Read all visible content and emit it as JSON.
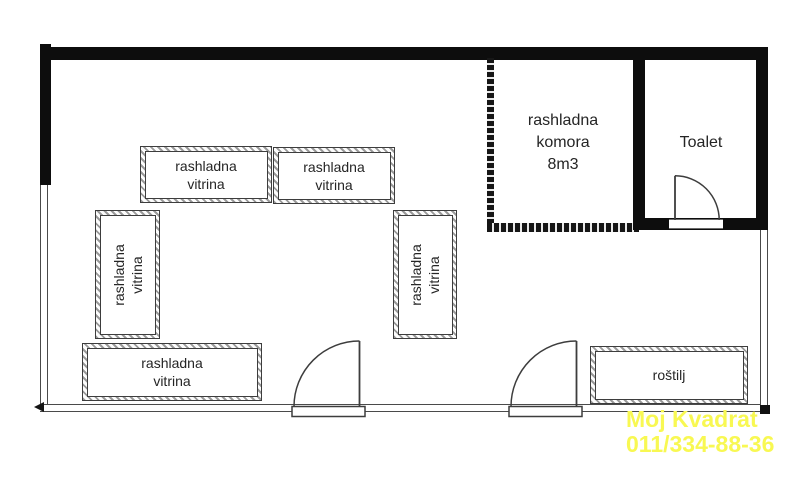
{
  "furniture": [
    {
      "id": "vitrina-top-left",
      "line1": "rashladna",
      "line2": "vitrina"
    },
    {
      "id": "vitrina-top-right",
      "line1": "rashladna",
      "line2": "vitrina"
    },
    {
      "id": "vitrina-left-vertical",
      "line1": "rashladna",
      "line2": "vitrina"
    },
    {
      "id": "vitrina-middle-vertical",
      "line1": "rashladna",
      "line2": "vitrina"
    },
    {
      "id": "vitrina-bottom-left",
      "line1": "rashladna",
      "line2": "vitrina"
    },
    {
      "id": "rostilj",
      "line1": "roštilj"
    }
  ],
  "rooms": {
    "komora": {
      "line1": "rashladna",
      "line2": "komora",
      "line3": "8m3"
    },
    "toalet": {
      "label": "Toalet"
    }
  },
  "watermark": {
    "line1": "Moj Kvadrat",
    "line2": "011/334-88-36",
    "color": "#f8f852"
  },
  "colors": {
    "wall": "#0d0d0d",
    "line": "#3d3d3d",
    "watermark_yellow": "#f8f852"
  }
}
